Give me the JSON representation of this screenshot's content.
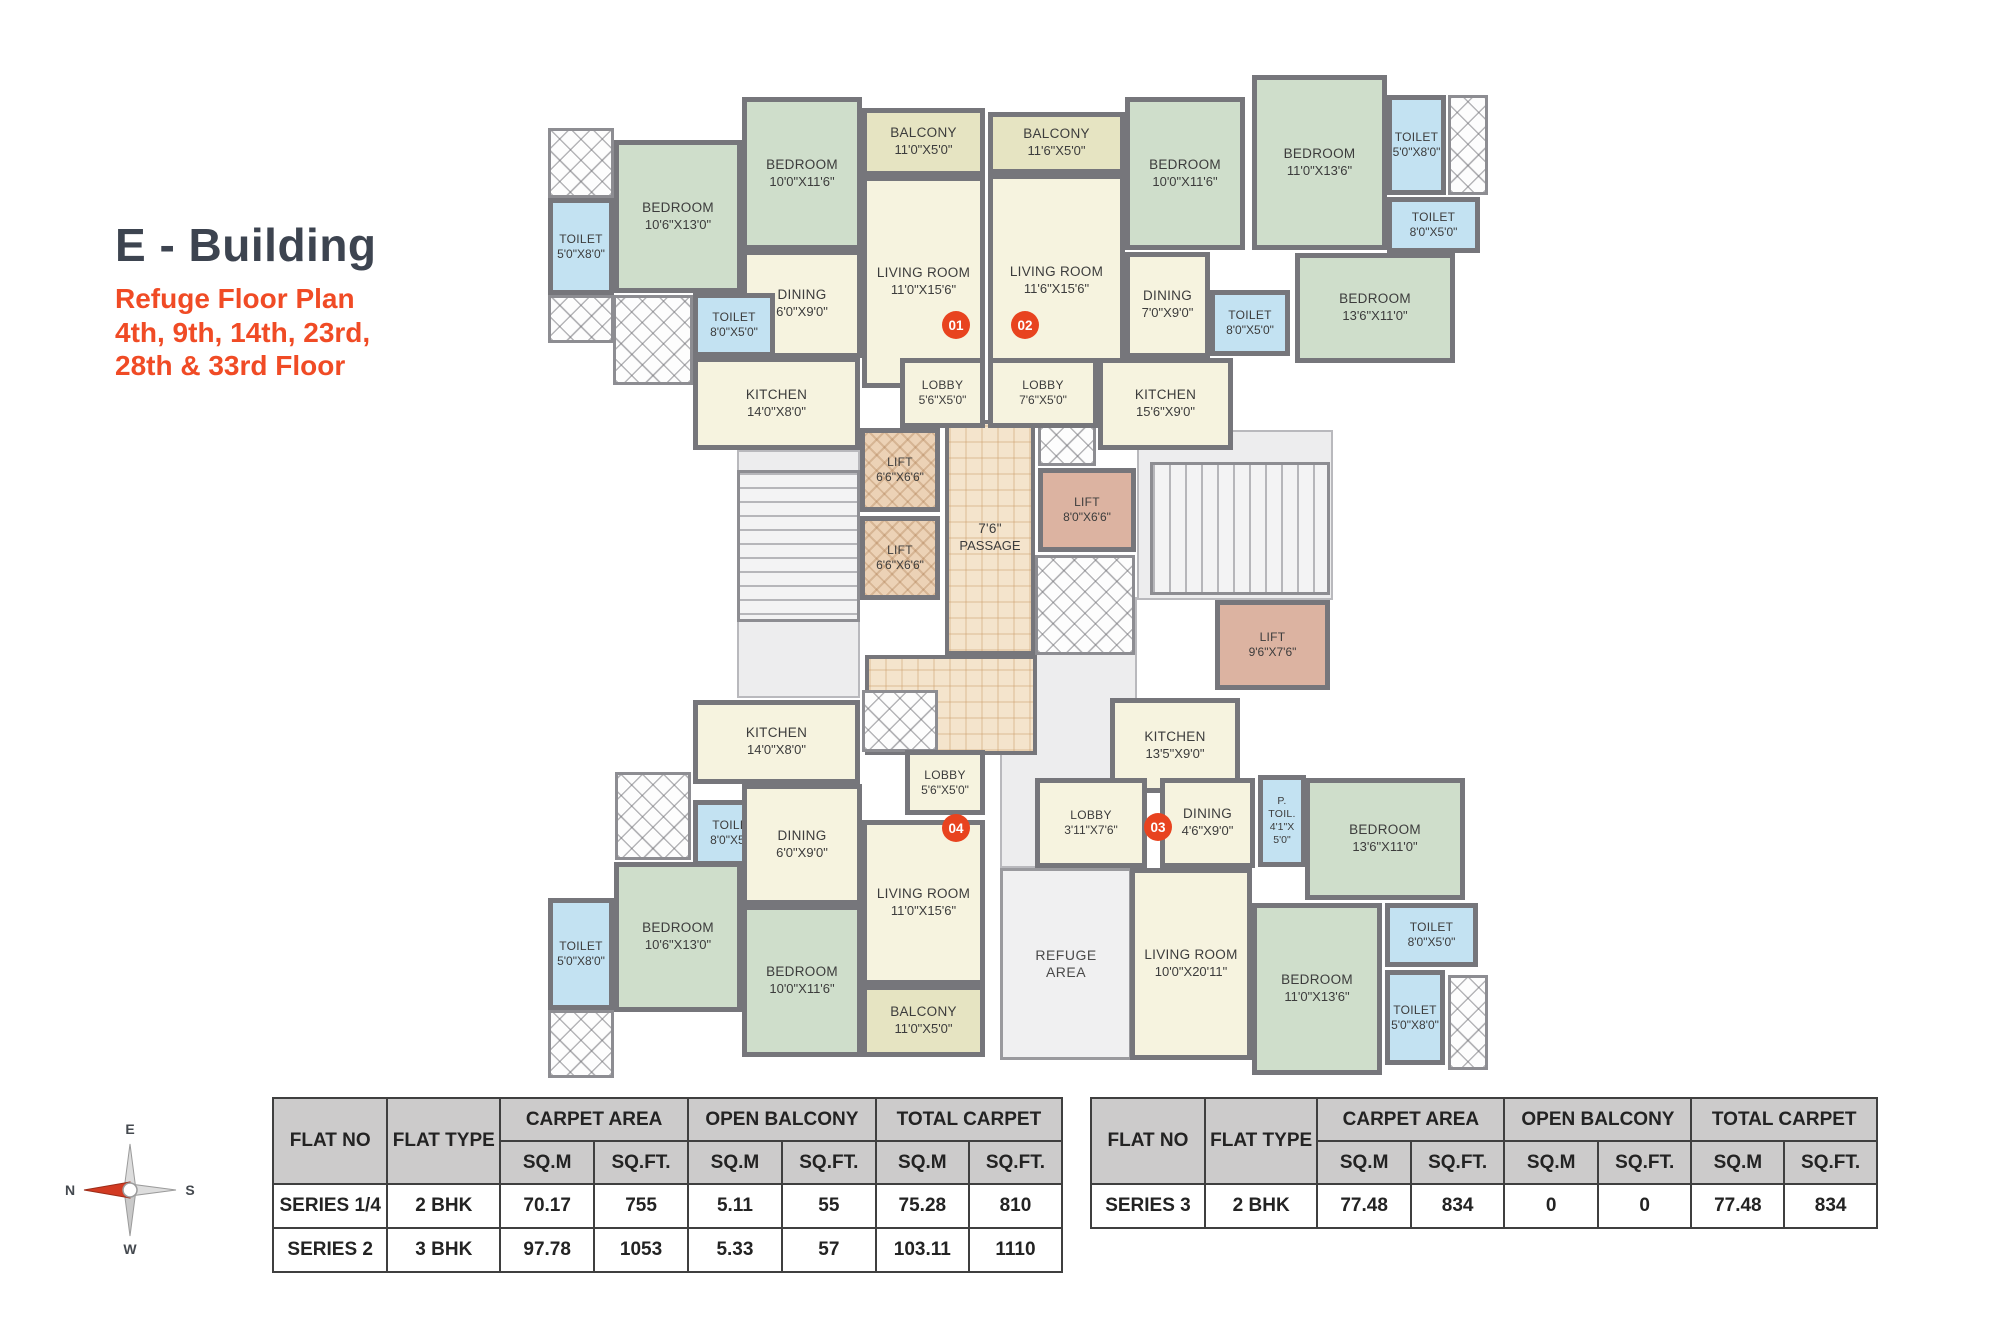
{
  "title": {
    "building": "E - Building",
    "plan_name": "Refuge Floor Plan",
    "floors_line1": "4th, 9th, 14th, 23rd,",
    "floors_line2": "28th & 33rd Floor"
  },
  "colors": {
    "wall": "#76767b",
    "bedroom": "#cfdecb",
    "cream": "#f6f3df",
    "balcony": "#e6e4c2",
    "toilet": "#c3e2f2",
    "lift_tan": "#ecd2b6",
    "lift_pink": "#dcb3a1",
    "passage": "#f4e4cc",
    "zone": "#ededee",
    "accent": "#e8431f",
    "accent2": "#f04b25",
    "title_dark": "#3d4450",
    "table_header_bg": "#cccbcb",
    "table_border": "#3f3f3f"
  },
  "floor_plan": {
    "rooms": [
      {
        "label": "",
        "dims": "",
        "type": "zone",
        "rect": [
          737,
          450,
          123,
          248
        ]
      },
      {
        "label": "",
        "dims": "",
        "type": "zone",
        "rect": [
          1000,
          597,
          137,
          271
        ]
      },
      {
        "label": "",
        "dims": "",
        "type": "zone",
        "rect": [
          1137,
          430,
          196,
          170
        ]
      },
      {
        "label": "REFUGE",
        "dims": "AREA",
        "type": "refuge",
        "rect": [
          1000,
          868,
          132,
          192
        ]
      },
      {
        "label": "",
        "dims": "",
        "type": "stairs-h",
        "rect": [
          737,
          470,
          123,
          152
        ]
      },
      {
        "label": "",
        "dims": "",
        "type": "stairs-v",
        "rect": [
          1150,
          462,
          180,
          133
        ]
      },
      {
        "label": "7'6\"",
        "dims": "PASSAGE",
        "type": "passage",
        "rect": [
          945,
          420,
          90,
          235
        ]
      },
      {
        "label": "",
        "dims": "",
        "type": "passage",
        "rect": [
          865,
          655,
          172,
          100
        ]
      },
      {
        "label": "",
        "dims": "",
        "type": "shaft",
        "rect": [
          548,
          128,
          66,
          70
        ]
      },
      {
        "label": "",
        "dims": "",
        "type": "shaft",
        "rect": [
          548,
          295,
          66,
          48
        ]
      },
      {
        "label": "",
        "dims": "",
        "type": "shaft",
        "rect": [
          613,
          295,
          80,
          90
        ]
      },
      {
        "label": "",
        "dims": "",
        "type": "shaft",
        "rect": [
          1038,
          420,
          58,
          46
        ]
      },
      {
        "label": "",
        "dims": "",
        "type": "shaft",
        "rect": [
          1035,
          555,
          100,
          100
        ]
      },
      {
        "label": "",
        "dims": "",
        "type": "shaft",
        "rect": [
          862,
          690,
          76,
          62
        ]
      },
      {
        "label": "",
        "dims": "",
        "type": "shaft",
        "rect": [
          615,
          772,
          76,
          88
        ]
      },
      {
        "label": "",
        "dims": "",
        "type": "shaft",
        "rect": [
          548,
          1010,
          66,
          68
        ]
      },
      {
        "label": "",
        "dims": "",
        "type": "shaft",
        "rect": [
          1448,
          95,
          40,
          100
        ]
      },
      {
        "label": "",
        "dims": "",
        "type": "shaft",
        "rect": [
          1448,
          975,
          40,
          95
        ]
      },
      {
        "label": "LIFT",
        "dims": "6'6\"X6'6\"",
        "type": "lift-a",
        "rect": [
          860,
          428,
          80,
          84
        ]
      },
      {
        "label": "LIFT",
        "dims": "6'6\"X6'6\"",
        "type": "lift-a",
        "rect": [
          860,
          516,
          80,
          84
        ]
      },
      {
        "label": "LIFT",
        "dims": "8'0\"X6'6\"",
        "type": "lift-b",
        "rect": [
          1038,
          468,
          98,
          84
        ]
      },
      {
        "label": "LIFT",
        "dims": "9'6\"X7'6\"",
        "type": "lift-b",
        "rect": [
          1215,
          600,
          115,
          90
        ]
      },
      {
        "label": "TOILET",
        "dims": "5'0\"X8'0\"",
        "type": "toilet",
        "rect": [
          548,
          198,
          66,
          97
        ]
      },
      {
        "label": "BEDROOM",
        "dims": "10'6\"X13'0\"",
        "type": "bedroom",
        "rect": [
          614,
          140,
          128,
          153
        ]
      },
      {
        "label": "BEDROOM",
        "dims": "10'0\"X11'6\"",
        "type": "bedroom",
        "rect": [
          742,
          97,
          120,
          153
        ]
      },
      {
        "label": "BALCONY",
        "dims": "11'0\"X5'0\"",
        "type": "balcony",
        "rect": [
          862,
          108,
          123,
          68
        ]
      },
      {
        "label": "LIVING ROOM",
        "dims": "11'0\"X15'6\"",
        "type": "living",
        "rect": [
          862,
          176,
          123,
          212
        ]
      },
      {
        "label": "DINING",
        "dims": "6'0\"X9'0\"",
        "type": "dining",
        "rect": [
          742,
          250,
          120,
          108
        ]
      },
      {
        "label": "TOILET",
        "dims": "8'0\"X5'0\"",
        "type": "toilet",
        "rect": [
          693,
          293,
          82,
          64
        ]
      },
      {
        "label": "KITCHEN",
        "dims": "14'0\"X8'0\"",
        "type": "kitchen",
        "rect": [
          693,
          357,
          167,
          93
        ]
      },
      {
        "label": "LOBBY",
        "dims": "5'6\"X5'0\"",
        "type": "lobby",
        "rect": [
          900,
          358,
          85,
          70
        ]
      },
      {
        "label": "BALCONY",
        "dims": "11'6\"X5'0\"",
        "type": "balcony",
        "rect": [
          988,
          112,
          137,
          62
        ]
      },
      {
        "label": "LIVING ROOM",
        "dims": "11'6\"X15'6\"",
        "type": "living",
        "rect": [
          988,
          174,
          137,
          214
        ]
      },
      {
        "label": "BEDROOM",
        "dims": "10'0\"X11'6\"",
        "type": "bedroom",
        "rect": [
          1125,
          97,
          120,
          153
        ]
      },
      {
        "label": "BEDROOM",
        "dims": "11'0\"X13'6\"",
        "type": "bedroom",
        "rect": [
          1252,
          75,
          135,
          175
        ]
      },
      {
        "label": "TOILET",
        "dims": "5'0\"X8'0\"",
        "type": "toilet",
        "rect": [
          1387,
          95,
          59,
          100
        ]
      },
      {
        "label": "TOILET",
        "dims": "8'0\"X5'0\"",
        "type": "toilet",
        "rect": [
          1387,
          197,
          93,
          56
        ]
      },
      {
        "label": "BEDROOM",
        "dims": "13'6\"X11'0\"",
        "type": "bedroom",
        "rect": [
          1295,
          253,
          160,
          110
        ]
      },
      {
        "label": "DINING",
        "dims": "7'0\"X9'0\"",
        "type": "dining",
        "rect": [
          1125,
          252,
          85,
          106
        ]
      },
      {
        "label": "TOILET",
        "dims": "8'0\"X5'0\"",
        "type": "toilet",
        "rect": [
          1210,
          290,
          80,
          66
        ]
      },
      {
        "label": "KITCHEN",
        "dims": "15'6\"X9'0\"",
        "type": "kitchen",
        "rect": [
          1098,
          358,
          135,
          92
        ]
      },
      {
        "label": "LOBBY",
        "dims": "7'6\"X5'0\"",
        "type": "lobby",
        "rect": [
          988,
          358,
          110,
          70
        ]
      },
      {
        "label": "KITCHEN",
        "dims": "14'0\"X8'0\"",
        "type": "kitchen",
        "rect": [
          693,
          700,
          167,
          84
        ]
      },
      {
        "label": "TOILET",
        "dims": "8'0\"X5'0\"",
        "type": "toilet",
        "rect": [
          693,
          800,
          82,
          66
        ]
      },
      {
        "label": "DINING",
        "dims": "6'0\"X9'0\"",
        "type": "dining",
        "rect": [
          742,
          784,
          120,
          121
        ]
      },
      {
        "label": "LOBBY",
        "dims": "5'6\"X5'0\"",
        "type": "lobby",
        "rect": [
          905,
          750,
          80,
          65
        ]
      },
      {
        "label": "LIVING ROOM",
        "dims": "11'0\"X15'6\"",
        "type": "living",
        "rect": [
          862,
          820,
          123,
          165
        ]
      },
      {
        "label": "BALCONY",
        "dims": "11'0\"X5'0\"",
        "type": "balcony",
        "rect": [
          862,
          985,
          123,
          72
        ]
      },
      {
        "label": "BEDROOM",
        "dims": "10'0\"X11'6\"",
        "type": "bedroom",
        "rect": [
          742,
          905,
          120,
          152
        ]
      },
      {
        "label": "BEDROOM",
        "dims": "10'6\"X13'0\"",
        "type": "bedroom",
        "rect": [
          614,
          862,
          128,
          150
        ]
      },
      {
        "label": "TOILET",
        "dims": "5'0\"X8'0\"",
        "type": "toilet",
        "rect": [
          548,
          898,
          66,
          112
        ]
      },
      {
        "label": "KITCHEN",
        "dims": "13'5\"X9'0\"",
        "type": "kitchen",
        "rect": [
          1110,
          698,
          130,
          95
        ]
      },
      {
        "label": "LOBBY",
        "dims": "3'11\"X7'6\"",
        "type": "lobby",
        "rect": [
          1035,
          778,
          112,
          90
        ]
      },
      {
        "label": "DINING",
        "dims": "4'6\"X9'0\"",
        "type": "dining",
        "rect": [
          1160,
          778,
          95,
          90
        ]
      },
      {
        "label": "P. TOIL.",
        "dims": "4'1\"X 5'0\"",
        "type": "ptoil",
        "rect": [
          1258,
          775,
          48,
          92
        ]
      },
      {
        "label": "LIVING ROOM",
        "dims": "10'0\"X20'11\"",
        "type": "living",
        "rect": [
          1130,
          868,
          122,
          192
        ]
      },
      {
        "label": "BEDROOM",
        "dims": "13'6\"X11'0\"",
        "type": "bedroom",
        "rect": [
          1305,
          778,
          160,
          122
        ]
      },
      {
        "label": "BEDROOM",
        "dims": "11'0\"X13'6\"",
        "type": "bedroom",
        "rect": [
          1252,
          903,
          130,
          172
        ]
      },
      {
        "label": "TOILET",
        "dims": "8'0\"X5'0\"",
        "type": "toilet",
        "rect": [
          1385,
          903,
          93,
          64
        ]
      },
      {
        "label": "TOILET",
        "dims": "5'0\"X8'0\"",
        "type": "toilet",
        "rect": [
          1385,
          970,
          60,
          95
        ]
      }
    ],
    "flat_markers": [
      {
        "no": "01",
        "x": 956,
        "y": 325
      },
      {
        "no": "02",
        "x": 1025,
        "y": 325
      },
      {
        "no": "04",
        "x": 956,
        "y": 828
      },
      {
        "no": "03",
        "x": 1158,
        "y": 827
      }
    ]
  },
  "tables": [
    {
      "id": "left",
      "pos": {
        "left": 272,
        "top": 1097,
        "width": 791
      },
      "headers": {
        "flat_no": "FLAT NO",
        "flat_type": "FLAT TYPE",
        "groups": [
          {
            "label": "CARPET AREA",
            "sub": [
              "SQ.M",
              "SQ.FT."
            ]
          },
          {
            "label": "OPEN BALCONY",
            "sub": [
              "SQ.M",
              "SQ.FT."
            ]
          },
          {
            "label": "TOTAL CARPET",
            "sub": [
              "SQ.M",
              "SQ.FT."
            ]
          }
        ]
      },
      "rows": [
        [
          "SERIES 1/4",
          "2 BHK",
          "70.17",
          "755",
          "5.11",
          "55",
          "75.28",
          "810"
        ],
        [
          "SERIES 2",
          "3 BHK",
          "97.78",
          "1053",
          "5.33",
          "57",
          "103.11",
          "1110"
        ]
      ]
    },
    {
      "id": "right",
      "pos": {
        "left": 1090,
        "top": 1097,
        "width": 788
      },
      "headers": {
        "flat_no": "FLAT NO",
        "flat_type": "FLAT TYPE",
        "groups": [
          {
            "label": "CARPET AREA",
            "sub": [
              "SQ.M",
              "SQ.FT."
            ]
          },
          {
            "label": "OPEN BALCONY",
            "sub": [
              "SQ.M",
              "SQ.FT."
            ]
          },
          {
            "label": "TOTAL CARPET",
            "sub": [
              "SQ.M",
              "SQ.FT."
            ]
          }
        ]
      },
      "rows": [
        [
          "SERIES 3",
          "2 BHK",
          "77.48",
          "834",
          "0",
          "0",
          "77.48",
          "834"
        ]
      ]
    }
  ],
  "compass": {
    "top": "E",
    "left": "N",
    "right": "S",
    "bottom": "W"
  }
}
